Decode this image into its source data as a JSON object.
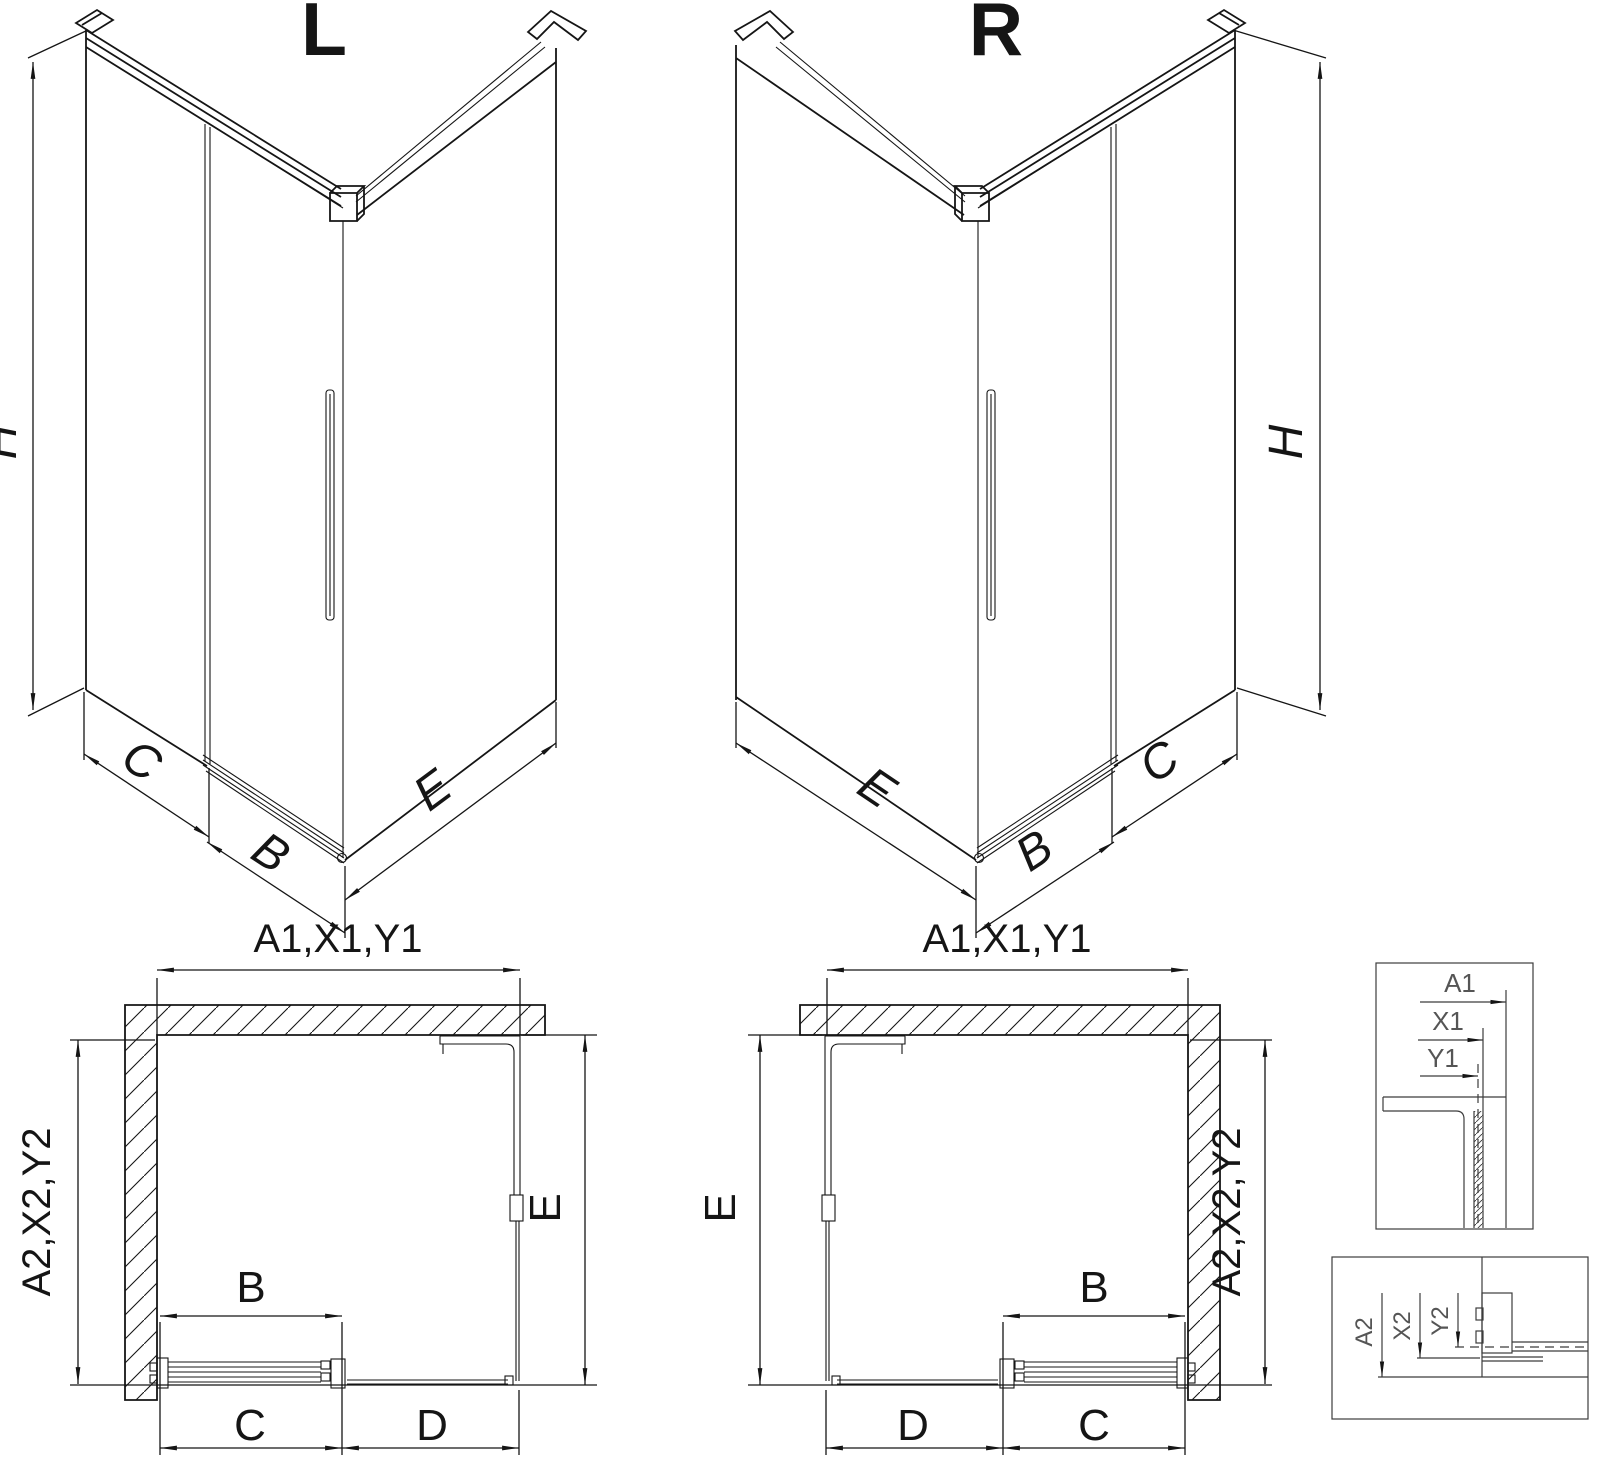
{
  "colors": {
    "background": "#ffffff",
    "line": "#151515",
    "detail_line": "#3c3c3c",
    "detail_label": "#555555"
  },
  "iso_left": {
    "variant_label": "L",
    "dim_height": "H",
    "dim_fixed_panel": "C",
    "dim_door": "B",
    "dim_side_panel": "E"
  },
  "iso_right": {
    "variant_label": "R",
    "dim_height": "H",
    "dim_fixed_panel": "C",
    "dim_door": "B",
    "dim_side_panel": "E"
  },
  "plan_left": {
    "dim_front_total": "A1,X1,Y1",
    "dim_depth_total": "A2,X2,Y2",
    "dim_side_panel": "E",
    "dim_door": "B",
    "dim_fixed_segment": "C",
    "dim_opening": "D"
  },
  "plan_right": {
    "dim_front_total": "A1,X1,Y1",
    "dim_depth_total": "A2,X2,Y2",
    "dim_side_panel": "E",
    "dim_door": "B",
    "dim_fixed_segment": "C",
    "dim_opening": "D"
  },
  "detail_front_widths": {
    "labels": [
      "A1",
      "X1",
      "Y1"
    ]
  },
  "detail_depth_widths": {
    "labels": [
      "A2",
      "X2",
      "Y2"
    ]
  }
}
